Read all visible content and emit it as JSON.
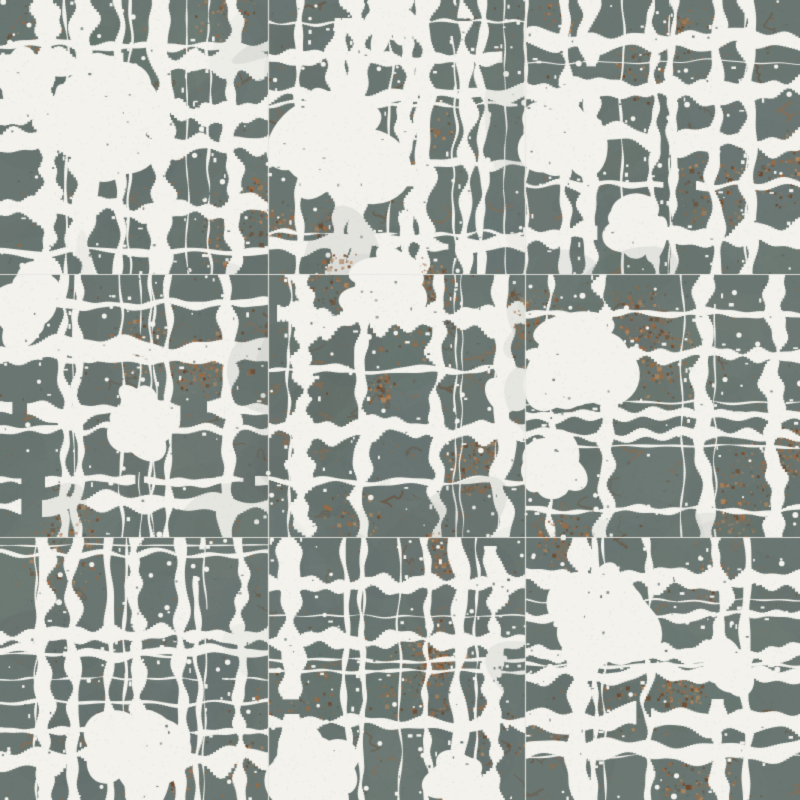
{
  "image": {
    "title": "Abstract patchwork tile texture",
    "description": "Seamless 3x3 grid of square ceramic-style tiles with an abstract plaid patchwork pattern: slate gray-green blocks carved by ragged white dry-brush streaks, scattered copper-rust flecks and marbling, on a warm off-white ground, separated by faint grout seams",
    "grid": {
      "rows": 3,
      "cols": 3,
      "width": 800,
      "height": 800,
      "col_bounds": [
        0,
        268,
        525,
        800
      ],
      "row_bounds": [
        0,
        274,
        537,
        800
      ]
    },
    "palette": {
      "background": "#f3f2ed",
      "slate": "#6a7672",
      "slate_dark": "#586460",
      "slate_light": "#7e8984",
      "copper": "#a06b42",
      "copper_dark": "#6f4526",
      "copper_light": "#bd8a5c",
      "seam": "#e9e7e0",
      "speck_dark": "#3d4643",
      "speck_light": "#ffffff"
    },
    "seed": 1370258,
    "texture": {
      "grain_dark_count": 1100,
      "grain_light_count": 600,
      "pinhole_count": 48,
      "white_speck_count": 55,
      "tonal_patch_count": 26,
      "sparse_copper_count": 90
    },
    "tiles": [
      {
        "seed": 101,
        "h_streaks": 6,
        "v_streaks": 5,
        "hairlines": 5,
        "thickness": 1.0,
        "white_patches": [
          [
            0.35,
            0.42,
            0.22
          ],
          [
            0.07,
            0.3,
            0.11
          ]
        ],
        "copper_clusters": 5,
        "marble": 12
      },
      {
        "seed": 202,
        "h_streaks": 4,
        "v_streaks": 7,
        "hairlines": 6,
        "thickness": 1.0,
        "white_patches": [
          [
            0.28,
            0.52,
            0.24
          ],
          [
            0.45,
            0.08,
            0.1
          ]
        ],
        "copper_clusters": 7,
        "marble": 20
      },
      {
        "seed": 303,
        "h_streaks": 5,
        "v_streaks": 6,
        "hairlines": 5,
        "thickness": 0.9,
        "white_patches": [
          [
            0.12,
            0.5,
            0.16
          ],
          [
            0.4,
            0.85,
            0.12
          ]
        ],
        "copper_clusters": 6,
        "marble": 15
      },
      {
        "seed": 404,
        "h_streaks": 7,
        "v_streaks": 4,
        "hairlines": 6,
        "thickness": 0.9,
        "white_patches": [
          [
            0.12,
            0.12,
            0.14
          ],
          [
            0.52,
            0.55,
            0.13
          ]
        ],
        "copper_clusters": 6,
        "marble": 18
      },
      {
        "seed": 505,
        "h_streaks": 4,
        "v_streaks": 4,
        "hairlines": 4,
        "thickness": 1.1,
        "white_patches": [
          [
            0.45,
            0.05,
            0.15
          ],
          [
            0.95,
            0.45,
            0.1
          ]
        ],
        "copper_clusters": 10,
        "marble": 45
      },
      {
        "seed": 606,
        "h_streaks": 5,
        "v_streaks": 4,
        "hairlines": 5,
        "thickness": 1.0,
        "white_patches": [
          [
            0.18,
            0.35,
            0.22
          ],
          [
            0.1,
            0.75,
            0.12
          ]
        ],
        "copper_clusters": 7,
        "marble": 20
      },
      {
        "seed": 707,
        "h_streaks": 5,
        "v_streaks": 7,
        "hairlines": 7,
        "thickness": 0.9,
        "white_patches": [
          [
            0.5,
            0.84,
            0.19
          ]
        ],
        "copper_clusters": 4,
        "marble": 8
      },
      {
        "seed": 808,
        "h_streaks": 3,
        "v_streaks": 6,
        "hairlines": 6,
        "thickness": 1.0,
        "white_patches": [
          [
            0.18,
            0.88,
            0.17
          ],
          [
            0.75,
            0.93,
            0.12
          ]
        ],
        "copper_clusters": 7,
        "marble": 25
      },
      {
        "seed": 909,
        "h_streaks": 6,
        "v_streaks": 5,
        "hairlines": 5,
        "thickness": 1.0,
        "white_patches": [
          [
            0.3,
            0.3,
            0.19
          ],
          [
            0.75,
            0.5,
            0.1
          ]
        ],
        "copper_clusters": 7,
        "marble": 18
      }
    ]
  }
}
